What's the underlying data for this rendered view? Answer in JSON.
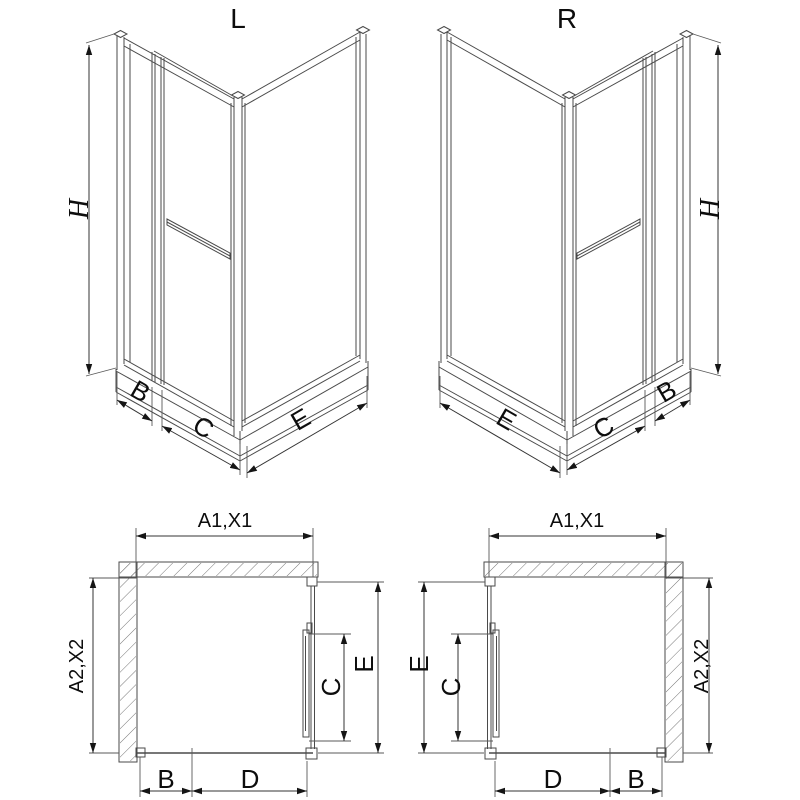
{
  "drawing": {
    "iso_left": {
      "title": "L",
      "h": "H",
      "b": "B",
      "c": "C",
      "e": "E"
    },
    "iso_right": {
      "title": "R",
      "h": "H",
      "b": "B",
      "c": "C",
      "e": "E"
    },
    "plan_left": {
      "a1": "A1,X1",
      "a2": "A2,X2",
      "e": "E",
      "c": "C",
      "b": "B",
      "d": "D"
    },
    "plan_right": {
      "a1": "A1,X1",
      "a2": "A2,X2",
      "e": "E",
      "c": "C",
      "b": "B",
      "d": "D"
    },
    "colors": {
      "line": "#4a4a4a",
      "dimension": "#333333",
      "text": "#0d0d0d",
      "accent_black": "#151515",
      "hatch": "#777777",
      "background": "#ffffff"
    }
  }
}
